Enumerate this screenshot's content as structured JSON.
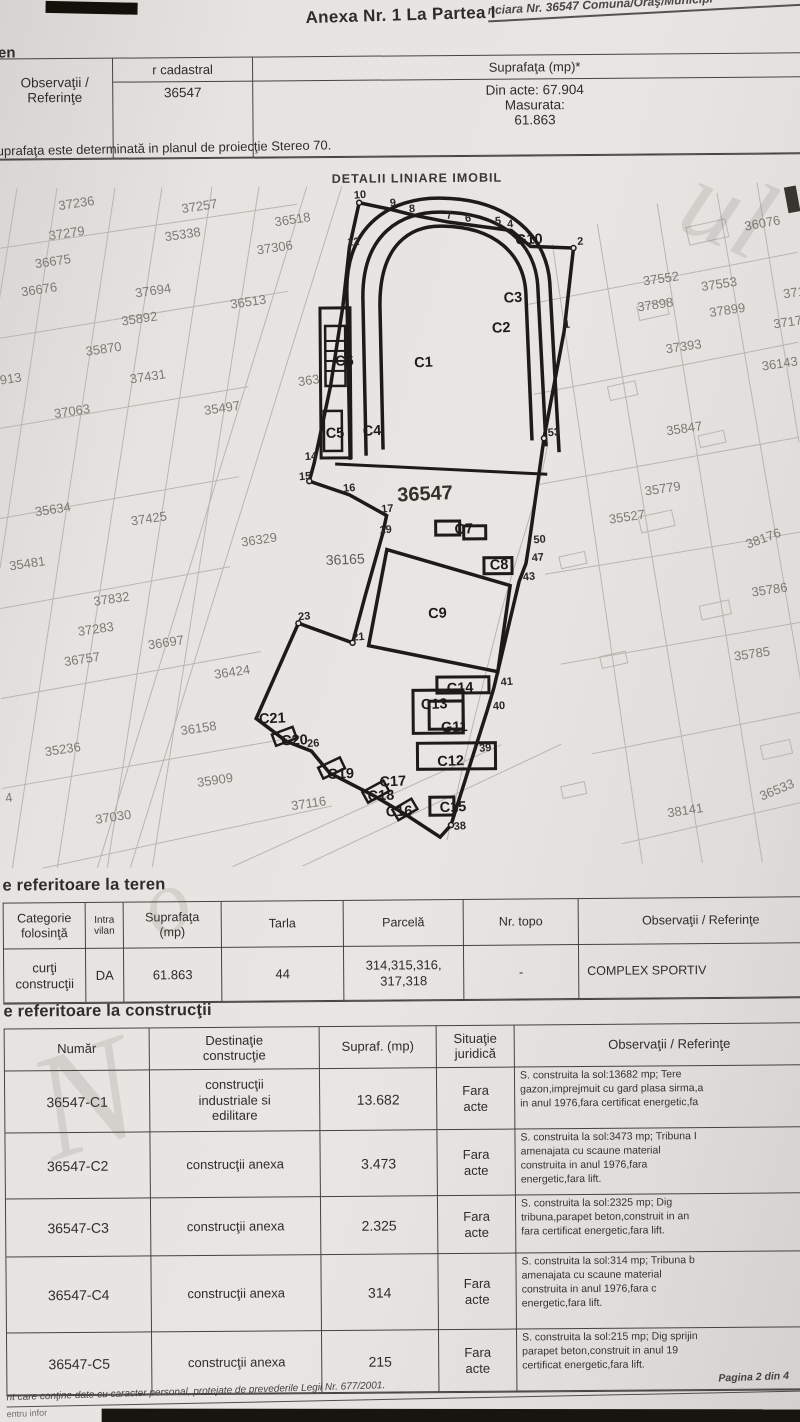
{
  "header": {
    "top_fragment": "nciara Nr. 36547 Comuna/Oraş/Municipi",
    "title": "Anexa Nr. 1 La Partea I",
    "teren_fragment": "en"
  },
  "cadastral_table": {
    "col_cadastral": "r cadastral",
    "col_suprafata": "Suprafaţa (mp)*",
    "col_observatii": "Observaţii / Referinţe",
    "nr_cadastral": "36547",
    "suprafata": "Din acte: 67.904\nMasurata:\n61.863"
  },
  "note": "uprafaţa este determinată in planul de proiecţie Stereo 70.",
  "map": {
    "title": "DETALII LINIARE IMOBIL",
    "parcel_labels": [
      {
        "x": 62,
        "y": 22,
        "t": "37236"
      },
      {
        "x": 185,
        "y": 26,
        "t": "37257"
      },
      {
        "x": 278,
        "y": 40,
        "t": "36518"
      },
      {
        "x": 748,
        "y": 48,
        "t": "36076",
        "r": -10
      },
      {
        "x": 52,
        "y": 52,
        "t": "37279"
      },
      {
        "x": 168,
        "y": 54,
        "t": "35338"
      },
      {
        "x": 260,
        "y": 68,
        "t": "37306"
      },
      {
        "x": 38,
        "y": 80,
        "t": "36675"
      },
      {
        "x": 646,
        "y": 102,
        "t": "37552"
      },
      {
        "x": 704,
        "y": 108,
        "t": "37553"
      },
      {
        "x": 24,
        "y": 108,
        "t": "36676"
      },
      {
        "x": 138,
        "y": 110,
        "t": "37694"
      },
      {
        "x": 233,
        "y": 122,
        "t": "36513"
      },
      {
        "x": 640,
        "y": 128,
        "t": "37898"
      },
      {
        "x": 712,
        "y": 134,
        "t": "37899"
      },
      {
        "x": 786,
        "y": 116,
        "t": "3717"
      },
      {
        "x": 124,
        "y": 138,
        "t": "35892"
      },
      {
        "x": 776,
        "y": 146,
        "t": "37177"
      },
      {
        "x": 88,
        "y": 168,
        "t": "35870"
      },
      {
        "x": 668,
        "y": 170,
        "t": "37393"
      },
      {
        "x": 764,
        "y": 188,
        "t": "36143"
      },
      {
        "x": 132,
        "y": 196,
        "t": "37431"
      },
      {
        "x": 2,
        "y": 196,
        "t": "913"
      },
      {
        "x": 300,
        "y": 200,
        "t": "363"
      },
      {
        "x": 56,
        "y": 230,
        "t": "37063"
      },
      {
        "x": 206,
        "y": 228,
        "t": "35497"
      },
      {
        "x": 668,
        "y": 252,
        "t": "35847"
      },
      {
        "x": 646,
        "y": 312,
        "t": "35779"
      },
      {
        "x": 36,
        "y": 328,
        "t": "35634"
      },
      {
        "x": 132,
        "y": 338,
        "t": "37425"
      },
      {
        "x": 610,
        "y": 340,
        "t": "35527"
      },
      {
        "x": 242,
        "y": 360,
        "t": "36329"
      },
      {
        "x": 748,
        "y": 366,
        "t": "38176",
        "r": -20
      },
      {
        "x": 10,
        "y": 382,
        "t": "35481"
      },
      {
        "x": 94,
        "y": 418,
        "t": "37832"
      },
      {
        "x": 752,
        "y": 414,
        "t": "35786"
      },
      {
        "x": 78,
        "y": 448,
        "t": "37283"
      },
      {
        "x": 148,
        "y": 462,
        "t": "36697"
      },
      {
        "x": 64,
        "y": 478,
        "t": "36757"
      },
      {
        "x": 214,
        "y": 492,
        "t": "36424"
      },
      {
        "x": 734,
        "y": 478,
        "t": "35785"
      },
      {
        "x": 180,
        "y": 548,
        "t": "36158"
      },
      {
        "x": 44,
        "y": 568,
        "t": "35236"
      },
      {
        "x": 196,
        "y": 600,
        "t": "35909"
      },
      {
        "x": 290,
        "y": 624,
        "t": "37116"
      },
      {
        "x": 94,
        "y": 636,
        "t": "37030"
      },
      {
        "x": 666,
        "y": 634,
        "t": "38141"
      },
      {
        "x": 760,
        "y": 618,
        "t": "36533",
        "r": -22
      },
      {
        "x": 4,
        "y": 614,
        "t": "4"
      }
    ],
    "labels": [
      {
        "x": 416,
        "y": 182,
        "t": "C1",
        "k": "b"
      },
      {
        "x": 494,
        "y": 148,
        "t": "C2",
        "k": "b"
      },
      {
        "x": 506,
        "y": 118,
        "t": "C3",
        "k": "b"
      },
      {
        "x": 364,
        "y": 250,
        "t": "C4",
        "k": "b"
      },
      {
        "x": 327,
        "y": 252,
        "t": "C5",
        "k": "b"
      },
      {
        "x": 337,
        "y": 180,
        "t": "C6",
        "k": "b"
      },
      {
        "x": 455,
        "y": 349,
        "t": "C7",
        "k": "b"
      },
      {
        "x": 490,
        "y": 385,
        "t": "C8",
        "k": "b"
      },
      {
        "x": 428,
        "y": 433,
        "t": "C9",
        "k": "b"
      },
      {
        "x": 436,
        "y": 581,
        "t": "C12",
        "k": "b"
      },
      {
        "x": 420,
        "y": 524,
        "t": "C13",
        "k": "b"
      },
      {
        "x": 446,
        "y": 508,
        "t": "C14",
        "k": "b"
      },
      {
        "x": 438,
        "y": 627,
        "t": "C15",
        "k": "b"
      },
      {
        "x": 384,
        "y": 631,
        "t": "C16",
        "k": "b"
      },
      {
        "x": 378,
        "y": 601,
        "t": "C17",
        "k": "b"
      },
      {
        "x": 366,
        "y": 615,
        "t": "C18",
        "k": "b"
      },
      {
        "x": 326,
        "y": 593,
        "t": "C19",
        "k": "b"
      },
      {
        "x": 280,
        "y": 559,
        "t": "C20",
        "k": "b"
      },
      {
        "x": 258,
        "y": 537,
        "t": "C21",
        "k": "b"
      },
      {
        "x": 440,
        "y": 547,
        "t": "G11",
        "k": "b"
      },
      {
        "x": 518,
        "y": 60,
        "t": "G10",
        "k": "b"
      },
      {
        "x": 398,
        "y": 316,
        "t": "36547",
        "k": "B"
      },
      {
        "x": 326,
        "y": 379,
        "t": "36165",
        "k": "g"
      },
      {
        "x": 357,
        "y": 13,
        "t": "10",
        "k": "v"
      },
      {
        "x": 393,
        "y": 21,
        "t": "9",
        "k": "v"
      },
      {
        "x": 412,
        "y": 27,
        "t": "8",
        "k": "v"
      },
      {
        "x": 449,
        "y": 34,
        "t": "7",
        "k": "v"
      },
      {
        "x": 468,
        "y": 37,
        "t": "6",
        "k": "v"
      },
      {
        "x": 498,
        "y": 40,
        "t": "5",
        "k": "v"
      },
      {
        "x": 510,
        "y": 43,
        "t": "4",
        "k": "v"
      },
      {
        "x": 580,
        "y": 61,
        "t": "2",
        "k": "v"
      },
      {
        "x": 350,
        "y": 60,
        "t": "12",
        "k": "v"
      },
      {
        "x": 566,
        "y": 144,
        "t": "1",
        "k": "v"
      },
      {
        "x": 549,
        "y": 252,
        "t": "53",
        "k": "v"
      },
      {
        "x": 534,
        "y": 359,
        "t": "50",
        "k": "v"
      },
      {
        "x": 532,
        "y": 377,
        "t": "47",
        "k": "v"
      },
      {
        "x": 523,
        "y": 396,
        "t": "43",
        "k": "v"
      },
      {
        "x": 500,
        "y": 501,
        "t": "41",
        "k": "v"
      },
      {
        "x": 492,
        "y": 525,
        "t": "40",
        "k": "v"
      },
      {
        "x": 478,
        "y": 567,
        "t": "39",
        "k": "v"
      },
      {
        "x": 452,
        "y": 645,
        "t": "38",
        "k": "v"
      },
      {
        "x": 306,
        "y": 274,
        "t": "14",
        "k": "v"
      },
      {
        "x": 300,
        "y": 294,
        "t": "15",
        "k": "v"
      },
      {
        "x": 344,
        "y": 306,
        "t": "16",
        "k": "v"
      },
      {
        "x": 382,
        "y": 327,
        "t": "17",
        "k": "v"
      },
      {
        "x": 380,
        "y": 348,
        "t": "19",
        "k": "v"
      },
      {
        "x": 298,
        "y": 434,
        "t": "23",
        "k": "v"
      },
      {
        "x": 352,
        "y": 455,
        "t": "21",
        "k": "v"
      },
      {
        "x": 306,
        "y": 561,
        "t": "26",
        "k": "v"
      }
    ]
  },
  "teren": {
    "heading": "e referitoare la teren",
    "col_categorie": "Categorie\nfolosinţă",
    "col_intravilan": "Intra\nvilan",
    "col_suprafata": "Suprafaţa\n(mp)",
    "col_tarla": "Tarla",
    "col_parcela": "Parcelă",
    "col_nrtopo": "Nr. topo",
    "col_observatii": "Observaţii / Referinţe",
    "row": {
      "categorie": "curţi\nconstrucţii",
      "intravilan": "DA",
      "suprafata": "61.863",
      "tarla": "44",
      "parcela": "314,315,316,\n317,318",
      "nr_topo": "-",
      "observatii": "COMPLEX SPORTIV"
    }
  },
  "constructii": {
    "heading": "e referitoare la construcţii",
    "col_numar": "Număr",
    "col_destinatie": "Destinaţie\nconstrucţie",
    "col_supraf": "Supraf. (mp)",
    "col_situatie": "Situaţie\njuridică",
    "col_observatii": "Observaţii / Referinţe",
    "rows": [
      {
        "numar": "36547-C1",
        "destinatie": "construcţii\nindustriale si\nedilitare",
        "supraf": "13.682",
        "situatie": "Fara\nacte",
        "observatii": "S. construita la sol:13682 mp;  Tere\ngazon,imprejmuit cu gard plasa sirma,a\nin anul 1976,fara certificat energetic,fa"
      },
      {
        "numar": "36547-C2",
        "destinatie": "construcţii anexa",
        "supraf": "3.473",
        "situatie": "Fara\nacte",
        "observatii": "S. construita la sol:3473 mp;  Tribuna I\namenajata  cu  scaune  material\nconstruita  in  anul  1976,fara\nenergetic,fara  lift."
      },
      {
        "numar": "36547-C3",
        "destinatie": "construcţii anexa",
        "supraf": "2.325",
        "situatie": "Fara\nacte",
        "observatii": "S. construita la sol:2325 mp;  Dig\ntribuna,parapet beton,construit in an\nfara certificat energetic,fara lift."
      },
      {
        "numar": "36547-C4",
        "destinatie": "construcţii anexa",
        "supraf": "314",
        "situatie": "Fara\nacte",
        "observatii": "S. construita la sol:314 mp;  Tribuna b\namenajata  cu  scaune  material\nconstruita  in  anul  1976,fara  c\nenergetic,fara  lift."
      },
      {
        "numar": "36547-C5",
        "destinatie": "construcţii anexa",
        "supraf": "215",
        "situatie": "Fara\nacte",
        "observatii": "S. construita la sol:215 mp;  Dig sprijin\nparapet beton,construit in anul 19\ncertificat energetic,fara lift."
      }
    ]
  },
  "footer": {
    "left_fragment": "nt care conţine date cu caracter personal, protejate de prevederile Legii Nr. 677/2001.",
    "page": "Pagina 2 din 4",
    "bottom_fragment": "entru infor"
  }
}
